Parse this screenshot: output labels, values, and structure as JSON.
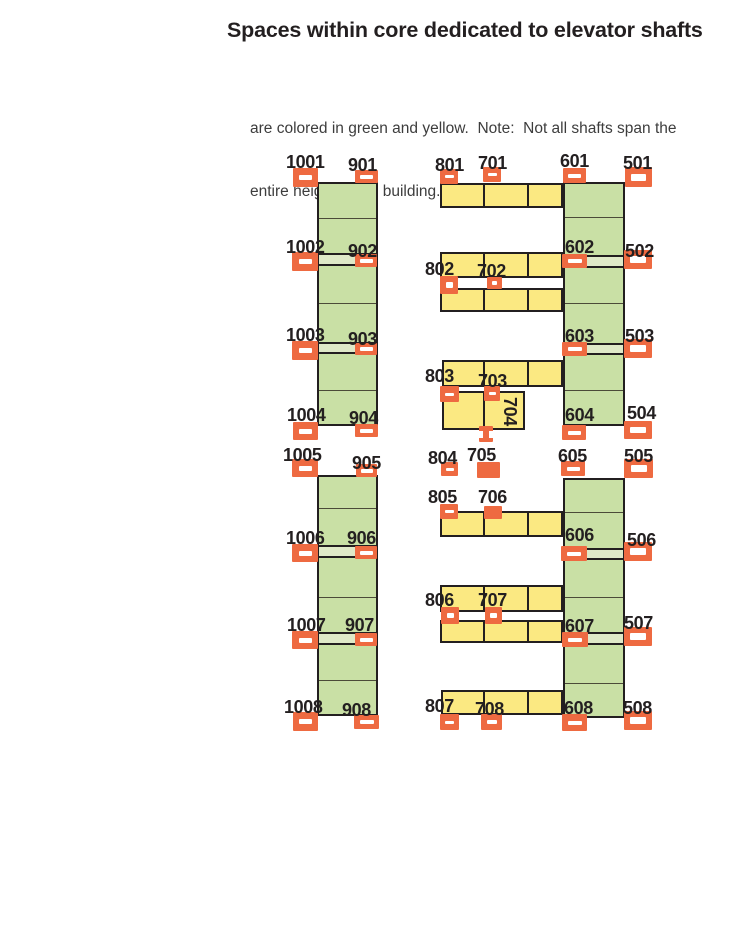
{
  "title": "Spaces within core dedicated to elevator shafts",
  "subtitle_lines": [
    "are colored in green and yellow.  Note:  Not all shafts span the",
    "entire height of the building."
  ],
  "colors": {
    "green": "#c9e0a5",
    "band": "#dfe9c8",
    "yellow": "#fbe982",
    "orange": "#ee6a41",
    "ink": "#231f20",
    "cell_line": "#4b4b38",
    "slot": "#ffffff",
    "background": "#ffffff"
  },
  "diagram": {
    "strips": [
      {
        "id": "left-upper",
        "x": 317,
        "y": 182,
        "w": 61,
        "h": 244,
        "dividers": [
          218,
          303,
          390
        ],
        "bands": [
          {
            "y": 253,
            "h": 13
          },
          {
            "y": 342,
            "h": 12
          }
        ]
      },
      {
        "id": "left-lower",
        "x": 317,
        "y": 475,
        "w": 61,
        "h": 241,
        "dividers": [
          508,
          597,
          680
        ],
        "bands": [
          {
            "y": 545,
            "h": 13
          },
          {
            "y": 632,
            "h": 13
          }
        ]
      },
      {
        "id": "right-upper",
        "x": 563,
        "y": 182,
        "w": 62,
        "h": 244,
        "dividers": [
          217,
          303,
          390
        ],
        "bands": [
          {
            "y": 255,
            "h": 13
          },
          {
            "y": 343,
            "h": 12
          }
        ]
      },
      {
        "id": "right-lower",
        "x": 563,
        "y": 478,
        "w": 62,
        "h": 240,
        "dividers": [
          512,
          597,
          683
        ],
        "bands": [
          {
            "y": 548,
            "h": 12
          },
          {
            "y": 632,
            "h": 13
          }
        ]
      }
    ],
    "bars": [
      {
        "id": "701",
        "x": 440,
        "y": 183,
        "w": 123,
        "h": 25,
        "dividers": [
          483,
          527
        ]
      },
      {
        "id": "702-upper",
        "x": 440,
        "y": 252,
        "w": 123,
        "h": 26,
        "dividers": [
          483,
          527
        ]
      },
      {
        "id": "702-lower",
        "x": 440,
        "y": 288,
        "w": 123,
        "h": 24,
        "dividers": [
          483,
          527
        ]
      },
      {
        "id": "703",
        "x": 442,
        "y": 360,
        "w": 121,
        "h": 27,
        "dividers": [
          483,
          527
        ]
      },
      {
        "id": "704-box",
        "x": 442,
        "y": 391,
        "w": 83,
        "h": 39,
        "dividers": [
          483
        ]
      },
      {
        "id": "706",
        "x": 440,
        "y": 511,
        "w": 123,
        "h": 26,
        "dividers": [
          483,
          527
        ]
      },
      {
        "id": "707-upper",
        "x": 440,
        "y": 585,
        "w": 123,
        "h": 27,
        "dividers": [
          483,
          527
        ]
      },
      {
        "id": "707-lower",
        "x": 440,
        "y": 620,
        "w": 123,
        "h": 23,
        "dividers": [
          483,
          527
        ]
      },
      {
        "id": "708",
        "x": 441,
        "y": 690,
        "w": 122,
        "h": 25,
        "dividers": [
          483,
          527
        ]
      }
    ],
    "markers": [
      {
        "id": "1001",
        "x": 293,
        "y": 168,
        "w": 25,
        "h": 19,
        "sw": 13,
        "sh": 5
      },
      {
        "id": "901",
        "x": 355,
        "y": 170,
        "w": 23,
        "h": 13,
        "sw": 13,
        "sh": 4
      },
      {
        "id": "1002",
        "x": 292,
        "y": 252,
        "w": 26,
        "h": 19,
        "sw": 13,
        "sh": 5
      },
      {
        "id": "902",
        "x": 355,
        "y": 254,
        "w": 22,
        "h": 13,
        "sw": 13,
        "sh": 4
      },
      {
        "id": "1003",
        "x": 292,
        "y": 341,
        "w": 26,
        "h": 19,
        "sw": 13,
        "sh": 5
      },
      {
        "id": "903",
        "x": 355,
        "y": 343,
        "w": 22,
        "h": 12,
        "sw": 13,
        "sh": 4
      },
      {
        "id": "1004",
        "x": 293,
        "y": 422,
        "w": 25,
        "h": 18,
        "sw": 13,
        "sh": 5
      },
      {
        "id": "904",
        "x": 355,
        "y": 424,
        "w": 23,
        "h": 13,
        "sw": 13,
        "sh": 4
      },
      {
        "id": "1005",
        "x": 292,
        "y": 459,
        "w": 26,
        "h": 18,
        "sw": 13,
        "sh": 5
      },
      {
        "id": "905",
        "x": 356,
        "y": 464,
        "w": 21,
        "h": 13,
        "sw": 12,
        "sh": 4
      },
      {
        "id": "1006",
        "x": 292,
        "y": 544,
        "w": 26,
        "h": 18,
        "sw": 13,
        "sh": 5
      },
      {
        "id": "906",
        "x": 355,
        "y": 546,
        "w": 22,
        "h": 13,
        "sw": 13,
        "sh": 4
      },
      {
        "id": "1007",
        "x": 292,
        "y": 631,
        "w": 26,
        "h": 18,
        "sw": 13,
        "sh": 5
      },
      {
        "id": "907",
        "x": 355,
        "y": 633,
        "w": 22,
        "h": 13,
        "sw": 13,
        "sh": 4
      },
      {
        "id": "1008",
        "x": 293,
        "y": 712,
        "w": 25,
        "h": 19,
        "sw": 13,
        "sh": 5
      },
      {
        "id": "908",
        "x": 354,
        "y": 715,
        "w": 25,
        "h": 14,
        "sw": 14,
        "sh": 4
      },
      {
        "id": "801",
        "x": 440,
        "y": 169,
        "w": 18,
        "h": 15,
        "sw": 9,
        "sh": 3
      },
      {
        "id": "701",
        "x": 483,
        "y": 167,
        "w": 18,
        "h": 15,
        "sw": 9,
        "sh": 3
      },
      {
        "id": "802",
        "x": 440,
        "y": 276,
        "w": 18,
        "h": 18,
        "sw": 7,
        "sh": 6
      },
      {
        "id": "702",
        "x": 487,
        "y": 277,
        "w": 15,
        "h": 12,
        "sw": 5,
        "sh": 4
      },
      {
        "id": "803",
        "x": 440,
        "y": 386,
        "w": 19,
        "h": 16,
        "sw": 9,
        "sh": 3
      },
      {
        "id": "703",
        "x": 484,
        "y": 386,
        "w": 16,
        "h": 15,
        "sw": 7,
        "sh": 3
      },
      {
        "id": "704",
        "x": 479,
        "y": 426,
        "w": 14,
        "h": 16,
        "sw": 0,
        "sh": 0,
        "style": "ibeam"
      },
      {
        "id": "804",
        "x": 441,
        "y": 462,
        "w": 17,
        "h": 14,
        "sw": 8,
        "sh": 3
      },
      {
        "id": "705",
        "x": 477,
        "y": 462,
        "w": 23,
        "h": 16,
        "sw": 0,
        "sh": 0
      },
      {
        "id": "805",
        "x": 440,
        "y": 504,
        "w": 18,
        "h": 15,
        "sw": 9,
        "sh": 3
      },
      {
        "id": "706",
        "x": 484,
        "y": 506,
        "w": 18,
        "h": 13,
        "sw": 0,
        "sh": 0
      },
      {
        "id": "806",
        "x": 441,
        "y": 607,
        "w": 18,
        "h": 17,
        "sw": 7,
        "sh": 5
      },
      {
        "id": "707",
        "x": 485,
        "y": 607,
        "w": 17,
        "h": 17,
        "sw": 7,
        "sh": 5
      },
      {
        "id": "807",
        "x": 440,
        "y": 714,
        "w": 19,
        "h": 16,
        "sw": 9,
        "sh": 3
      },
      {
        "id": "708",
        "x": 481,
        "y": 714,
        "w": 21,
        "h": 16,
        "sw": 10,
        "sh": 4
      },
      {
        "id": "601",
        "x": 563,
        "y": 168,
        "w": 23,
        "h": 15,
        "sw": 13,
        "sh": 4
      },
      {
        "id": "501",
        "x": 625,
        "y": 167,
        "w": 27,
        "h": 20,
        "sw": 15,
        "sh": 7
      },
      {
        "id": "602",
        "x": 562,
        "y": 254,
        "w": 25,
        "h": 14,
        "sw": 14,
        "sh": 4
      },
      {
        "id": "502",
        "x": 624,
        "y": 250,
        "w": 28,
        "h": 19,
        "sw": 16,
        "sh": 7
      },
      {
        "id": "603",
        "x": 562,
        "y": 342,
        "w": 25,
        "h": 14,
        "sw": 14,
        "sh": 4
      },
      {
        "id": "503",
        "x": 624,
        "y": 339,
        "w": 28,
        "h": 19,
        "sw": 16,
        "sh": 7
      },
      {
        "id": "604",
        "x": 562,
        "y": 425,
        "w": 24,
        "h": 15,
        "sw": 13,
        "sh": 4
      },
      {
        "id": "504",
        "x": 624,
        "y": 421,
        "w": 28,
        "h": 18,
        "sw": 16,
        "sh": 6
      },
      {
        "id": "605",
        "x": 561,
        "y": 461,
        "w": 24,
        "h": 15,
        "sw": 13,
        "sh": 4
      },
      {
        "id": "505",
        "x": 624,
        "y": 459,
        "w": 29,
        "h": 19,
        "sw": 16,
        "sh": 7
      },
      {
        "id": "606",
        "x": 561,
        "y": 546,
        "w": 26,
        "h": 15,
        "sw": 14,
        "sh": 4
      },
      {
        "id": "506",
        "x": 624,
        "y": 542,
        "w": 28,
        "h": 19,
        "sw": 16,
        "sh": 7
      },
      {
        "id": "607",
        "x": 562,
        "y": 632,
        "w": 26,
        "h": 15,
        "sw": 14,
        "sh": 4
      },
      {
        "id": "507",
        "x": 624,
        "y": 627,
        "w": 28,
        "h": 19,
        "sw": 16,
        "sh": 7
      },
      {
        "id": "608",
        "x": 562,
        "y": 714,
        "w": 25,
        "h": 17,
        "sw": 14,
        "sh": 4
      },
      {
        "id": "508",
        "x": 624,
        "y": 711,
        "w": 28,
        "h": 19,
        "sw": 16,
        "sh": 7
      }
    ],
    "labels": [
      {
        "text": "1001",
        "x": 286,
        "y": 153
      },
      {
        "text": "901",
        "x": 348,
        "y": 156
      },
      {
        "text": "1002",
        "x": 286,
        "y": 238
      },
      {
        "text": "902",
        "x": 348,
        "y": 242
      },
      {
        "text": "1003",
        "x": 286,
        "y": 326
      },
      {
        "text": "903",
        "x": 348,
        "y": 330
      },
      {
        "text": "1004",
        "x": 287,
        "y": 406
      },
      {
        "text": "904",
        "x": 349,
        "y": 409
      },
      {
        "text": "1005",
        "x": 283,
        "y": 446
      },
      {
        "text": "905",
        "x": 352,
        "y": 454
      },
      {
        "text": "1006",
        "x": 286,
        "y": 529
      },
      {
        "text": "906",
        "x": 347,
        "y": 529
      },
      {
        "text": "1007",
        "x": 287,
        "y": 616
      },
      {
        "text": "907",
        "x": 345,
        "y": 616
      },
      {
        "text": "1008",
        "x": 284,
        "y": 698
      },
      {
        "text": "908",
        "x": 342,
        "y": 701
      },
      {
        "text": "801",
        "x": 435,
        "y": 156
      },
      {
        "text": "701",
        "x": 478,
        "y": 154
      },
      {
        "text": "802",
        "x": 425,
        "y": 260
      },
      {
        "text": "702",
        "x": 477,
        "y": 262
      },
      {
        "text": "803",
        "x": 425,
        "y": 367
      },
      {
        "text": "703",
        "x": 478,
        "y": 372
      },
      {
        "text": "704",
        "x": 519,
        "y": 397,
        "rot": true
      },
      {
        "text": "804",
        "x": 428,
        "y": 449
      },
      {
        "text": "705",
        "x": 467,
        "y": 446
      },
      {
        "text": "805",
        "x": 428,
        "y": 488
      },
      {
        "text": "706",
        "x": 478,
        "y": 488
      },
      {
        "text": "806",
        "x": 425,
        "y": 591
      },
      {
        "text": "707",
        "x": 478,
        "y": 591
      },
      {
        "text": "807",
        "x": 425,
        "y": 697
      },
      {
        "text": "708",
        "x": 475,
        "y": 700
      },
      {
        "text": "601",
        "x": 560,
        "y": 152
      },
      {
        "text": "501",
        "x": 623,
        "y": 154
      },
      {
        "text": "602",
        "x": 565,
        "y": 238
      },
      {
        "text": "502",
        "x": 625,
        "y": 242
      },
      {
        "text": "603",
        "x": 565,
        "y": 327
      },
      {
        "text": "503",
        "x": 625,
        "y": 327
      },
      {
        "text": "604",
        "x": 565,
        "y": 406
      },
      {
        "text": "504",
        "x": 627,
        "y": 404
      },
      {
        "text": "605",
        "x": 558,
        "y": 447
      },
      {
        "text": "505",
        "x": 624,
        "y": 447
      },
      {
        "text": "606",
        "x": 565,
        "y": 526
      },
      {
        "text": "506",
        "x": 627,
        "y": 531
      },
      {
        "text": "607",
        "x": 565,
        "y": 617
      },
      {
        "text": "507",
        "x": 624,
        "y": 614
      },
      {
        "text": "608",
        "x": 564,
        "y": 699
      },
      {
        "text": "508",
        "x": 623,
        "y": 699
      }
    ]
  }
}
